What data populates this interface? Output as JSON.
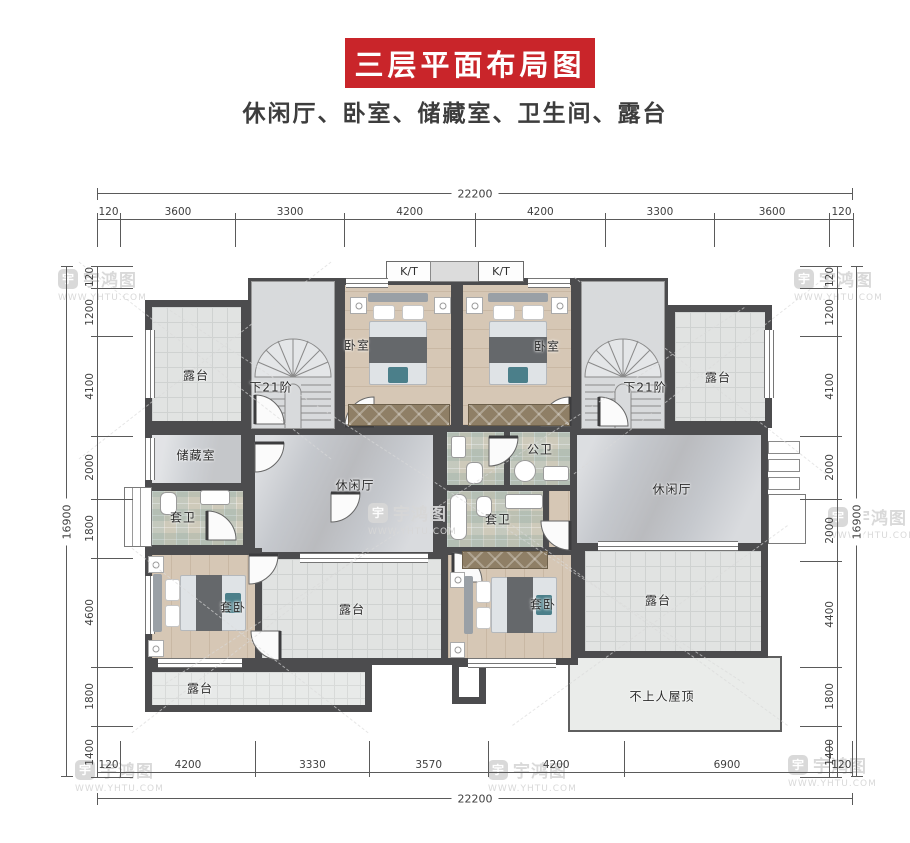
{
  "header": {
    "title": "三层平面布局图",
    "subtitle": "休闲厅、卧室、储藏室、卫生间、露台",
    "banner_color": "#c9252a"
  },
  "watermark": {
    "brand": "宇鸿图",
    "url": "WWW.YHTU.COM",
    "logo_char": "宇"
  },
  "rooms": {
    "terrace": "露台",
    "bedroom": "卧室",
    "storage": "储藏室",
    "ensuite_bath": "套卫",
    "public_bath": "公卫",
    "lounge": "休闲厅",
    "suite_bedroom": "套卧",
    "stairs_note": "下21阶",
    "roof_note": "不上人屋顶",
    "ac_platform": "K/T"
  },
  "dimensions": {
    "top": {
      "total": "22200",
      "segments": [
        "120",
        "3600",
        "3300",
        "4200",
        "4200",
        "3300",
        "3600",
        "120"
      ]
    },
    "bottom": {
      "total": "22200",
      "segments": [
        "120",
        "4200",
        "3330",
        "3570",
        "4200",
        "6900",
        "120"
      ]
    },
    "left": {
      "total": "16900",
      "segments": [
        "120",
        "1200",
        "4100",
        "2000",
        "1800",
        "4600",
        "1800",
        "1400"
      ]
    },
    "right": {
      "total": "16900",
      "segments": [
        "120",
        "1200",
        "4100",
        "2000",
        "2000",
        "4400",
        "1800",
        "1400"
      ]
    }
  },
  "colors": {
    "wall": "#4c4c4e",
    "accent_red": "#c9252a"
  }
}
